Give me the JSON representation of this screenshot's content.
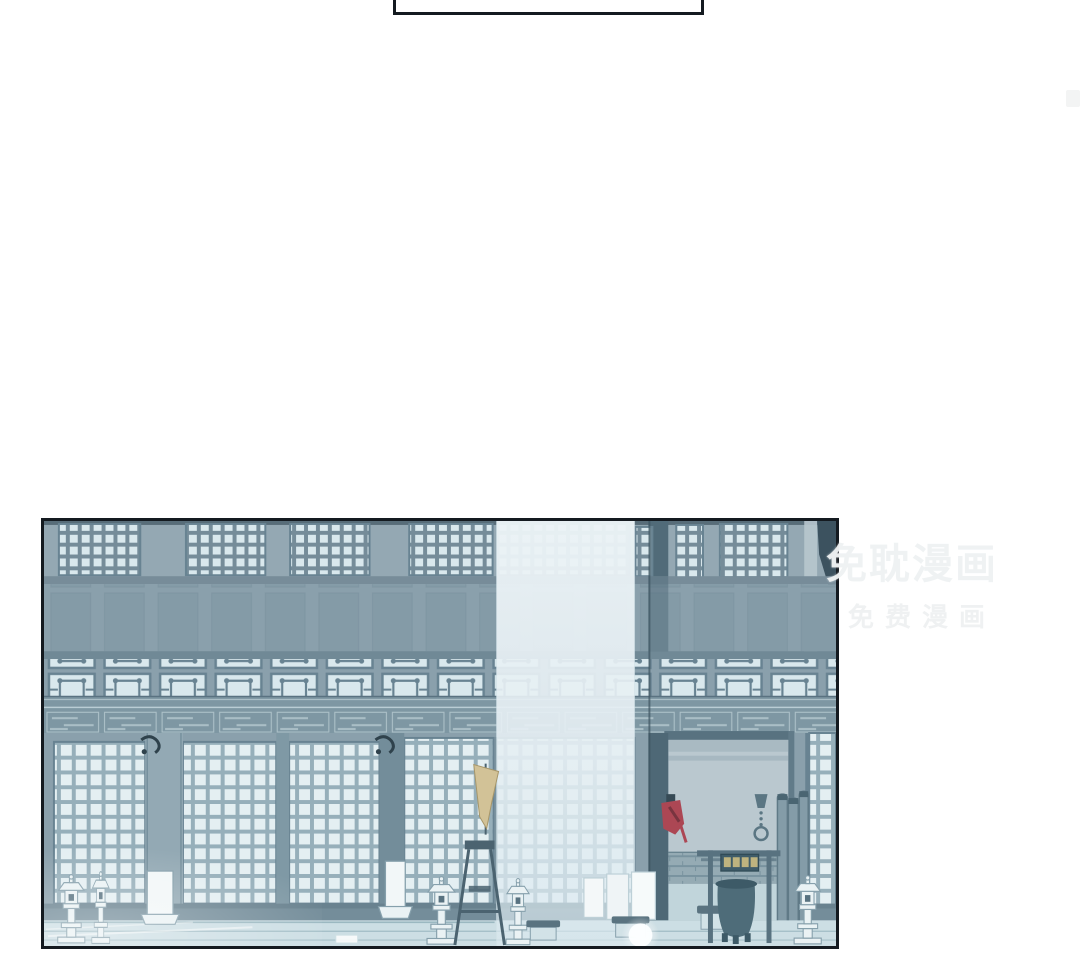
{
  "watermark": {
    "line1": "免耽漫画",
    "line2": "免费漫画"
  },
  "panel": {
    "alt": "Night view of a traditional palace hall facade: upper clerestory lattice windows, ornate transom panels, carved beam, large shoji lattice windows, a bright shaft of light, stone lanterns, banner stands, a tan pennant, benches, a gate plaque with gold glyphs, an incense cauldron, hanging chain ring, and a small red charm on a pillar"
  },
  "colors": {
    "ink": "#141a20",
    "wallTop": "#8ca2ae",
    "wallMid": "#8299a6",
    "wallDark": "#75909d",
    "beam": "#5d7a8a",
    "frameMid": "#6b8492",
    "frameDark": "#4c6877",
    "cellLight": "#d7e7ec",
    "cellBright": "#e2eef2",
    "muntin": "#8fa9b5",
    "pillarLight": "#8ba3af",
    "pillarMid": "#76929f",
    "pillarDark": "#698593",
    "pillarDeep": "#44606f",
    "doorway": "#b5c4cc",
    "doorTop": "#a3b5be",
    "brick": "#8da5af",
    "brickLine": "#6f8b98",
    "sill": "#5e7987",
    "baseBand": "#6a8593",
    "terrace": "#c9dce2",
    "terraceLine": "#8fafba",
    "lantern": "#e9f2f4",
    "outline": "#7d99a6",
    "darkwood": "#3e5866",
    "flag": "#cfbe90",
    "flagEdge": "#a08e5e",
    "plaque": "#31505e",
    "plaqueGold": "#c9b979",
    "red": "#a63a48",
    "redDark": "#6f2531",
    "columnTop": "#ebf3f6",
    "columnMid": "#e4eef3",
    "columnBot": "#d9e9ef",
    "wm": "#e9edee"
  }
}
